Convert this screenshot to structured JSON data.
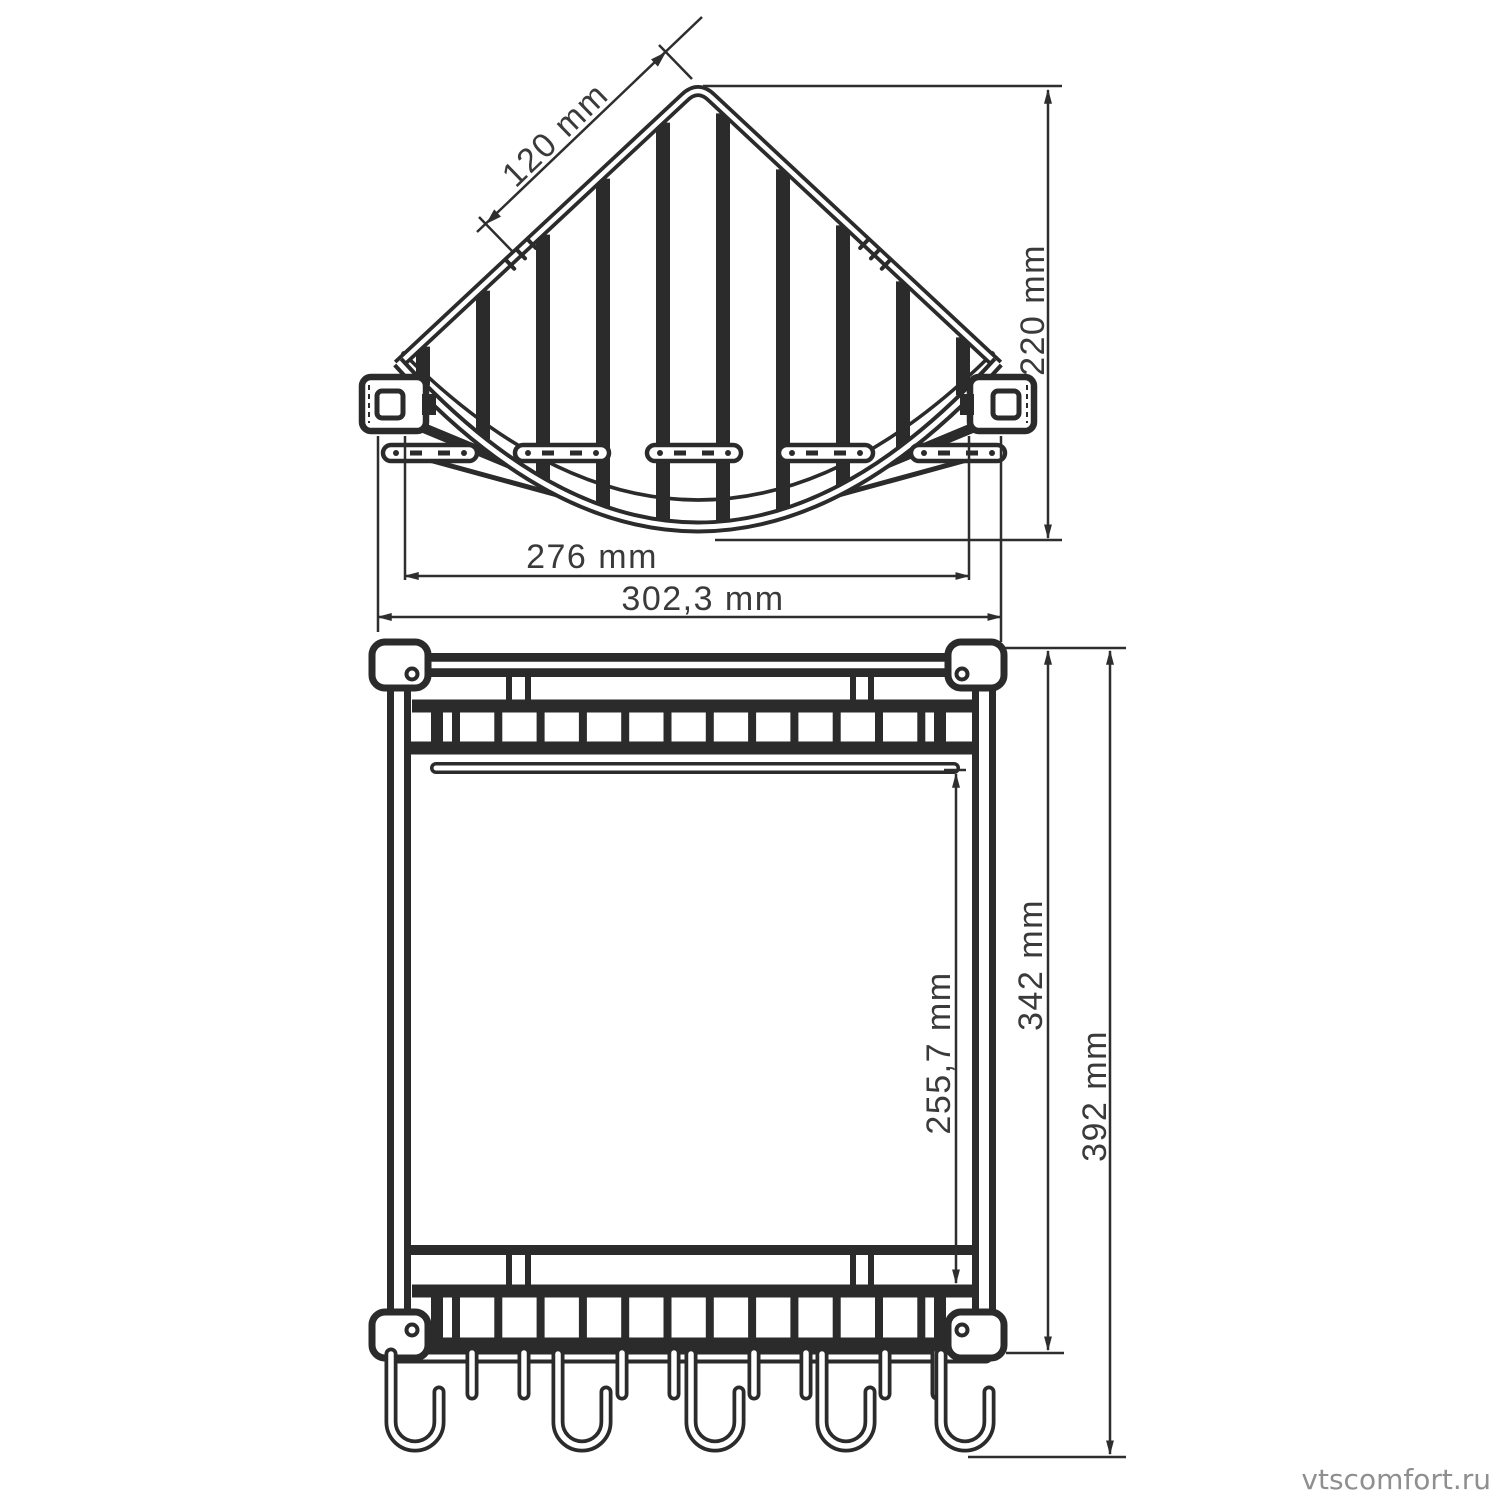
{
  "top_view": {
    "dim_edge": "120 mm",
    "dim_depth": "220 mm",
    "dim_width_inner": "276 mm",
    "dim_width_outer": "302,3 mm"
  },
  "front_view": {
    "dim_shelf_gap": "255,7 mm",
    "dim_frame_height": "342 mm",
    "dim_total_height": "392 mm"
  },
  "watermark": "vtscomfort.ru"
}
